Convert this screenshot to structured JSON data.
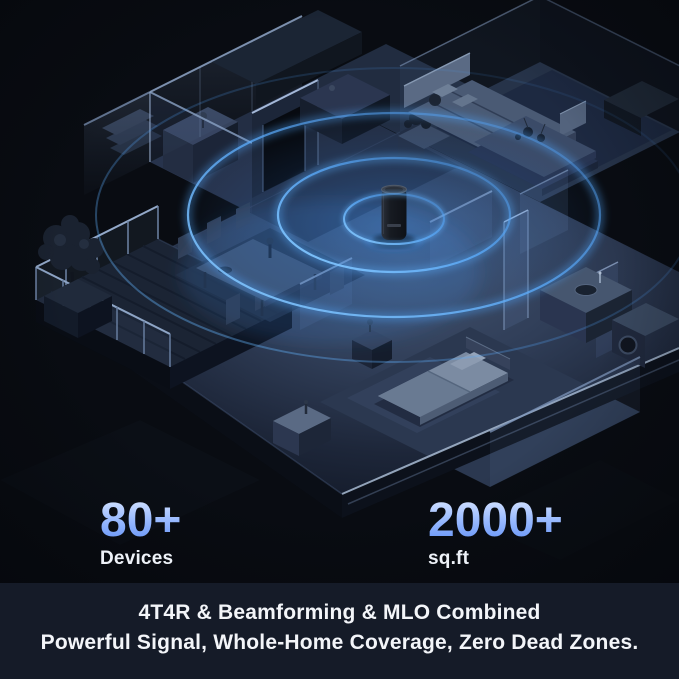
{
  "stats": [
    {
      "value": "80+",
      "label": "Devices"
    },
    {
      "value": "2000+",
      "label": "sq.ft"
    }
  ],
  "caption": {
    "line1": "4T4R & Beamforming & MLO Combined",
    "line2": "Powerful Signal, Whole-Home Coverage, Zero Dead Zones."
  },
  "colors": {
    "background": "#0a0d14",
    "caption_band": "#151b28",
    "stat_number_gradient_top": "#d9e6ff",
    "stat_number_gradient_bottom": "#5f8ff6",
    "stat_label": "#eef2f8",
    "caption_text": "#f3f5f9",
    "signal_ring": "#4aa4f0",
    "floor_highlight": "#46566f",
    "floor_shadow": "#131a28"
  },
  "scene_elements": [
    "wifi-router",
    "signal-rings",
    "sofa",
    "coffee-table",
    "dining-table",
    "dining-chairs",
    "sideboard",
    "kitchen-counter",
    "bed",
    "nightstand",
    "bathroom-vanity",
    "washing-machine",
    "balcony-deck",
    "balcony-railing",
    "tree",
    "glass-walls",
    "doorway",
    "stairs"
  ]
}
